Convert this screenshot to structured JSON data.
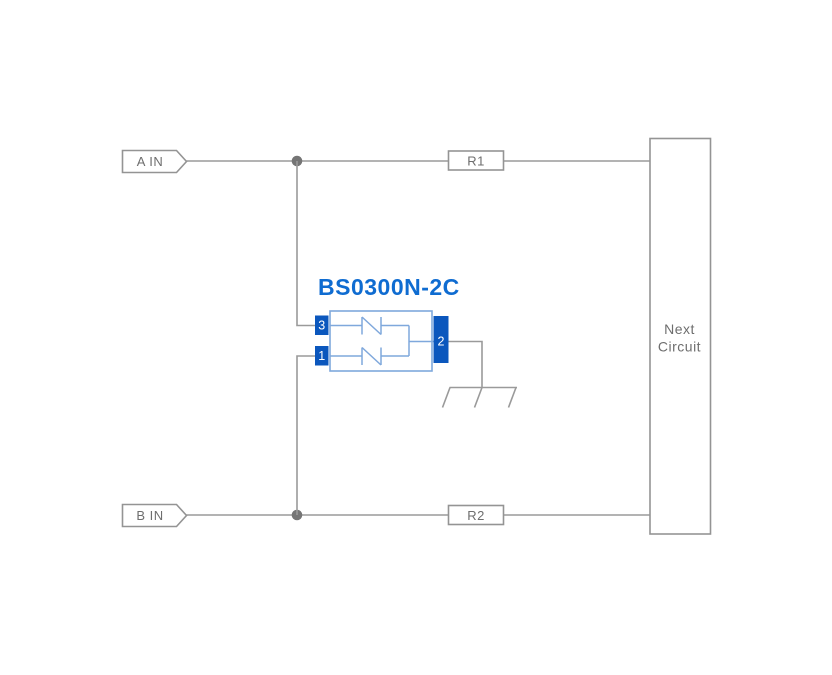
{
  "diagram": {
    "component": {
      "name": "BS0300N-2C",
      "pin_top_left": "3",
      "pin_bottom_left": "1",
      "pin_right": "2"
    },
    "inputs": {
      "a": "A IN",
      "b": "B IN"
    },
    "resistors": {
      "r1": "R1",
      "r2": "R2"
    },
    "next_circuit": {
      "line1": "Next",
      "line2": "Circuit"
    }
  },
  "colors": {
    "wire": "#9a9a9a",
    "box-border": "#949494",
    "label-text": "#6e6e6e",
    "junction": "#757575",
    "accent-blue": "#0f6cd1",
    "pin-blue": "#0b57bd",
    "light-blue": "#7fa8dc",
    "bg": "#ffffff"
  }
}
